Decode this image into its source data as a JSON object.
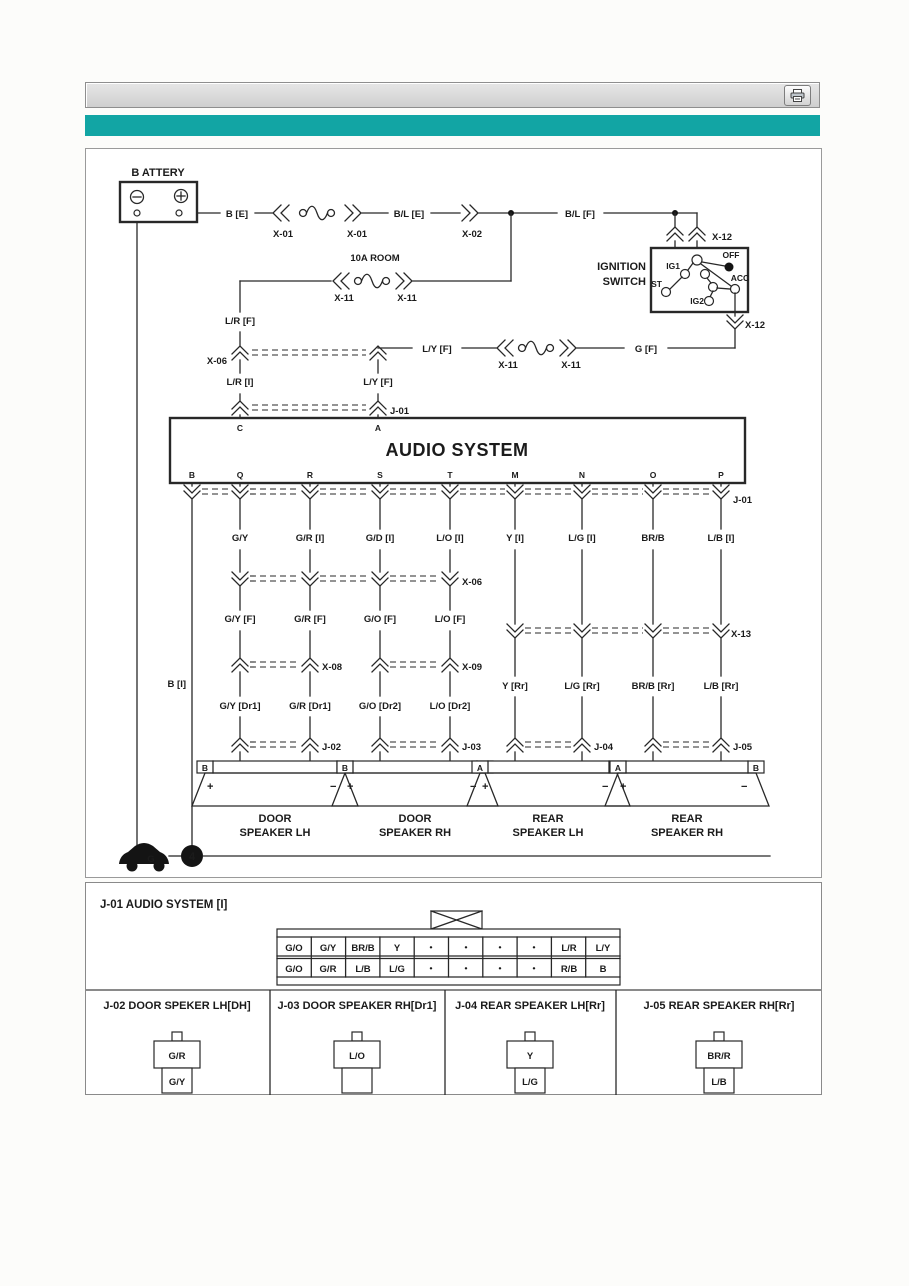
{
  "header": {
    "print_icon": "printer"
  },
  "colors": {
    "accent_teal": "#12A5A4",
    "toolbar_gray": "#D9D9D9"
  },
  "diagram": {
    "battery": {
      "label": "B ATTERY"
    },
    "fuse_labels": {
      "room": "10A ROOM"
    },
    "wire_labels": {
      "b_e": "B [E]",
      "bl_e": "B/L [E]",
      "bl_f": "B/L [F]",
      "lr_f": "L/R [F]",
      "lr_i": "L/R [I]",
      "ly_f_line": "L/Y [F]",
      "ly_f_col": "L/Y [F]",
      "g_f": "G [F]",
      "b_i": "B [I]"
    },
    "connector_labels": {
      "x01_left": "X-01",
      "x01_right": "X-01",
      "x02": "X-02",
      "x11_room_left": "X-11",
      "x11_room_right": "X-11",
      "x11_acc_left": "X-11",
      "x11_acc_right": "X-11",
      "x12_top": "X-12",
      "x12_bottom": "X-12",
      "x06_upper": "X-06",
      "x06_mid": "X-06",
      "x08": "X-08",
      "x09": "X-09",
      "x13": "X-13",
      "j01_upper": "J-01",
      "j01_lower": "J-01",
      "j02": "J-02",
      "j03": "J-03",
      "j04": "J-04",
      "j05": "J-05"
    },
    "ignition": {
      "name_line1": "IGNITION",
      "name_line2": "SWITCH",
      "pos_ig1": "IG1",
      "pos_st": "ST",
      "pos_ig2": "IG2",
      "pos_off": "OFF",
      "pos_acc": "ACC"
    },
    "audio": {
      "title": "AUDIO SYSTEM",
      "pin_c": "C",
      "pin_a": "A",
      "bottom_pins": [
        "B",
        "Q",
        "R",
        "S",
        "T",
        "M",
        "N",
        "O",
        "P"
      ]
    },
    "branch_wires": {
      "i_row": [
        "G/Y",
        "G/R [I]",
        "G/D [I]",
        "L/O [I]",
        "Y [I]",
        "L/G [I]",
        "BR/B",
        "L/B [I]"
      ],
      "f_row": [
        "G/Y [F]",
        "G/R [F]",
        "G/O [F]",
        "L/O [F]"
      ],
      "dr_row": [
        "G/Y [Dr1]",
        "G/R [Dr1]",
        "G/O [Dr2]",
        "L/O [Dr2]"
      ],
      "rr_row": [
        "Y [Rr]",
        "L/G [Rr]",
        "BR/B [Rr]",
        "L/B [Rr]"
      ]
    },
    "speakers": [
      {
        "line1": "DOOR",
        "line2": "SPEAKER LH",
        "pin_left": "B",
        "pin_right": "A",
        "plus": "+",
        "minus": "−"
      },
      {
        "line1": "DOOR",
        "line2": "SPEAKER RH",
        "pin_left": "B",
        "pin_right": "A",
        "plus": "+",
        "minus": "−"
      },
      {
        "line1": "REAR",
        "line2": "SPEAKER LH",
        "pin_left": "A",
        "pin_right": "B",
        "plus": "+",
        "minus": "−"
      },
      {
        "line1": "REAR",
        "line2": "SPEAKER RH",
        "pin_left": "A",
        "pin_right": "B",
        "plus": "+",
        "minus": "−"
      }
    ],
    "ground": {
      "symbol": "G",
      "node": "4"
    }
  },
  "j01_panel": {
    "title": "J-01 AUDIO SYSTEM [I]",
    "row1": [
      "G/O",
      "G/Y",
      "BR/B",
      "Y",
      "•",
      "•",
      "•",
      "•",
      "L/R",
      "L/Y"
    ],
    "row2": [
      "G/O",
      "G/R",
      "L/B",
      "L/G",
      "•",
      "•",
      "•",
      "•",
      "R/B",
      "B"
    ]
  },
  "connector_panels": [
    {
      "title": "J-02 DOOR SPEKER LH[DH]",
      "top_wire": "G/R",
      "bottom_wire": "G/Y"
    },
    {
      "title": "J-03 DOOR SPEAKER RH[Dr1]",
      "top_wire": "L/O",
      "bottom_wire": ""
    },
    {
      "title": "J-04 REAR SPEAKER LH[Rr]",
      "top_wire": "Y",
      "bottom_wire": "L/G"
    },
    {
      "title": "J-05 REAR SPEAKER RH[Rr]",
      "top_wire": "BR/R",
      "bottom_wire": "L/B"
    }
  ]
}
